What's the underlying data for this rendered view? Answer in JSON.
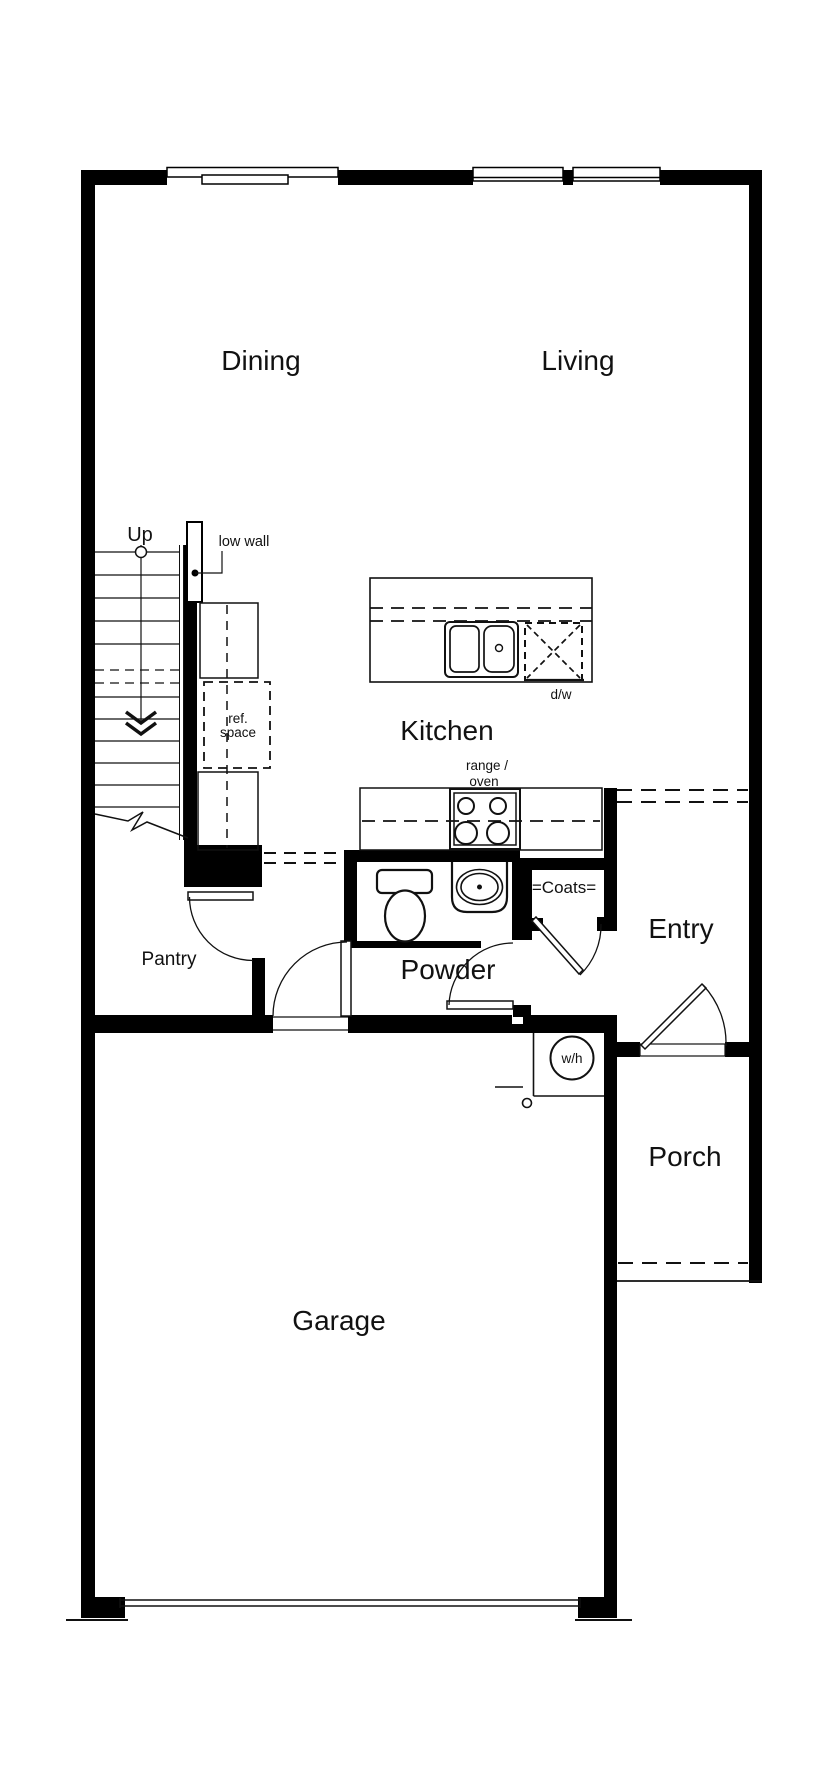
{
  "document": {
    "type": "floor-plan",
    "background_color": "#ffffff",
    "wall_color": "#000000",
    "line_color": "#111111"
  },
  "rooms": {
    "dining": "Dining",
    "living": "Living",
    "kitchen": "Kitchen",
    "pantry": "Pantry",
    "powder": "Powder",
    "entry": "Entry",
    "porch": "Porch",
    "garage": "Garage"
  },
  "annotations": {
    "up": "Up",
    "low_wall": "low wall",
    "ref_space_line1": "ref.",
    "ref_space_line2": "space",
    "range_oven_line1": "range /",
    "range_oven_line2": "oven",
    "dishwasher": "d/w",
    "water_heater": "w/h",
    "coats": "=Coats="
  }
}
